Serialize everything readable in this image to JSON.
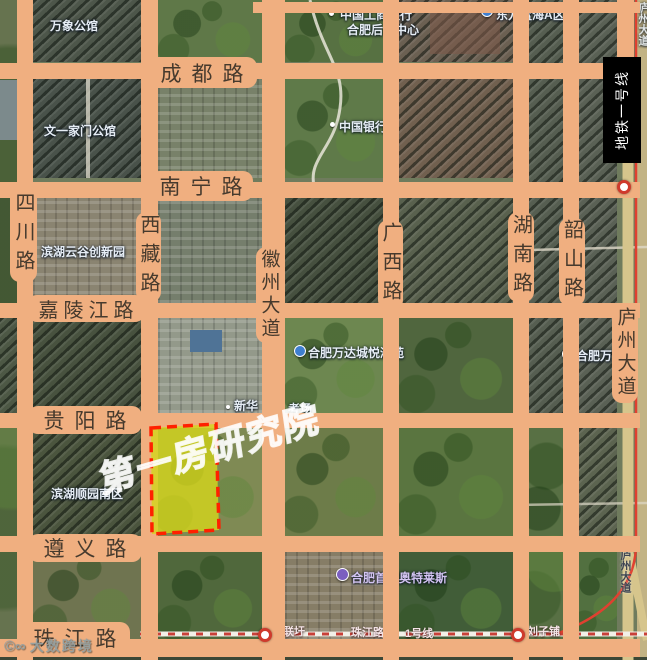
{
  "colors": {
    "road_overlay": "#f0af80",
    "road_label_text": "#463a2d",
    "parcel_fill": "#d3d41c",
    "parcel_border": "#ff2000",
    "metro_line_red": "#e04030",
    "metro_box_bg": "#000000",
    "metro_box_text": "#ffffff",
    "poi_blue": "#3f7fd0",
    "poi_purple": "#7b5fc0",
    "watermark_white": "#ffffff"
  },
  "roads": {
    "horizontal": [
      {
        "name": "成都路"
      },
      {
        "name": "南宁路"
      },
      {
        "name": "嘉陵江路"
      },
      {
        "name": "贵阳路"
      },
      {
        "name": "遵义路"
      },
      {
        "name": "珠江路"
      }
    ],
    "vertical": [
      {
        "name": "四川路"
      },
      {
        "name": "西藏路"
      },
      {
        "name": "徽州大道"
      },
      {
        "name": "广西路"
      },
      {
        "name": "湖南路"
      },
      {
        "name": "韶山路"
      },
      {
        "name": "庐州大道"
      }
    ]
  },
  "metro": {
    "info_box_label": "地铁一号线",
    "line_label": "1号线",
    "stations": [
      {
        "name": "九联圩"
      },
      {
        "name": "珠江路"
      },
      {
        "name": "刘子铺"
      }
    ]
  },
  "sat_labels": [
    {
      "text": "万象公馆"
    },
    {
      "text": "中国工商银行"
    },
    {
      "text": "合肥后台中心"
    },
    {
      "text": "东方蓝海A区"
    },
    {
      "text": "中国银行"
    },
    {
      "text": "文一家门公馆"
    },
    {
      "text": "滨湖云谷创新园"
    },
    {
      "text": "合肥万达城悦澜苑"
    },
    {
      "text": "合肥万达城"
    },
    {
      "text": "新华"
    },
    {
      "text": "考场"
    },
    {
      "text": "滨湖顺园南区"
    },
    {
      "text": "合肥首创奥特莱斯"
    },
    {
      "text": "庐州大道"
    },
    {
      "text": "庐州大道"
    }
  ],
  "watermark": {
    "text": "第一房研究院"
  },
  "credit": {
    "logo": "©∞",
    "text": "大数跨境"
  }
}
